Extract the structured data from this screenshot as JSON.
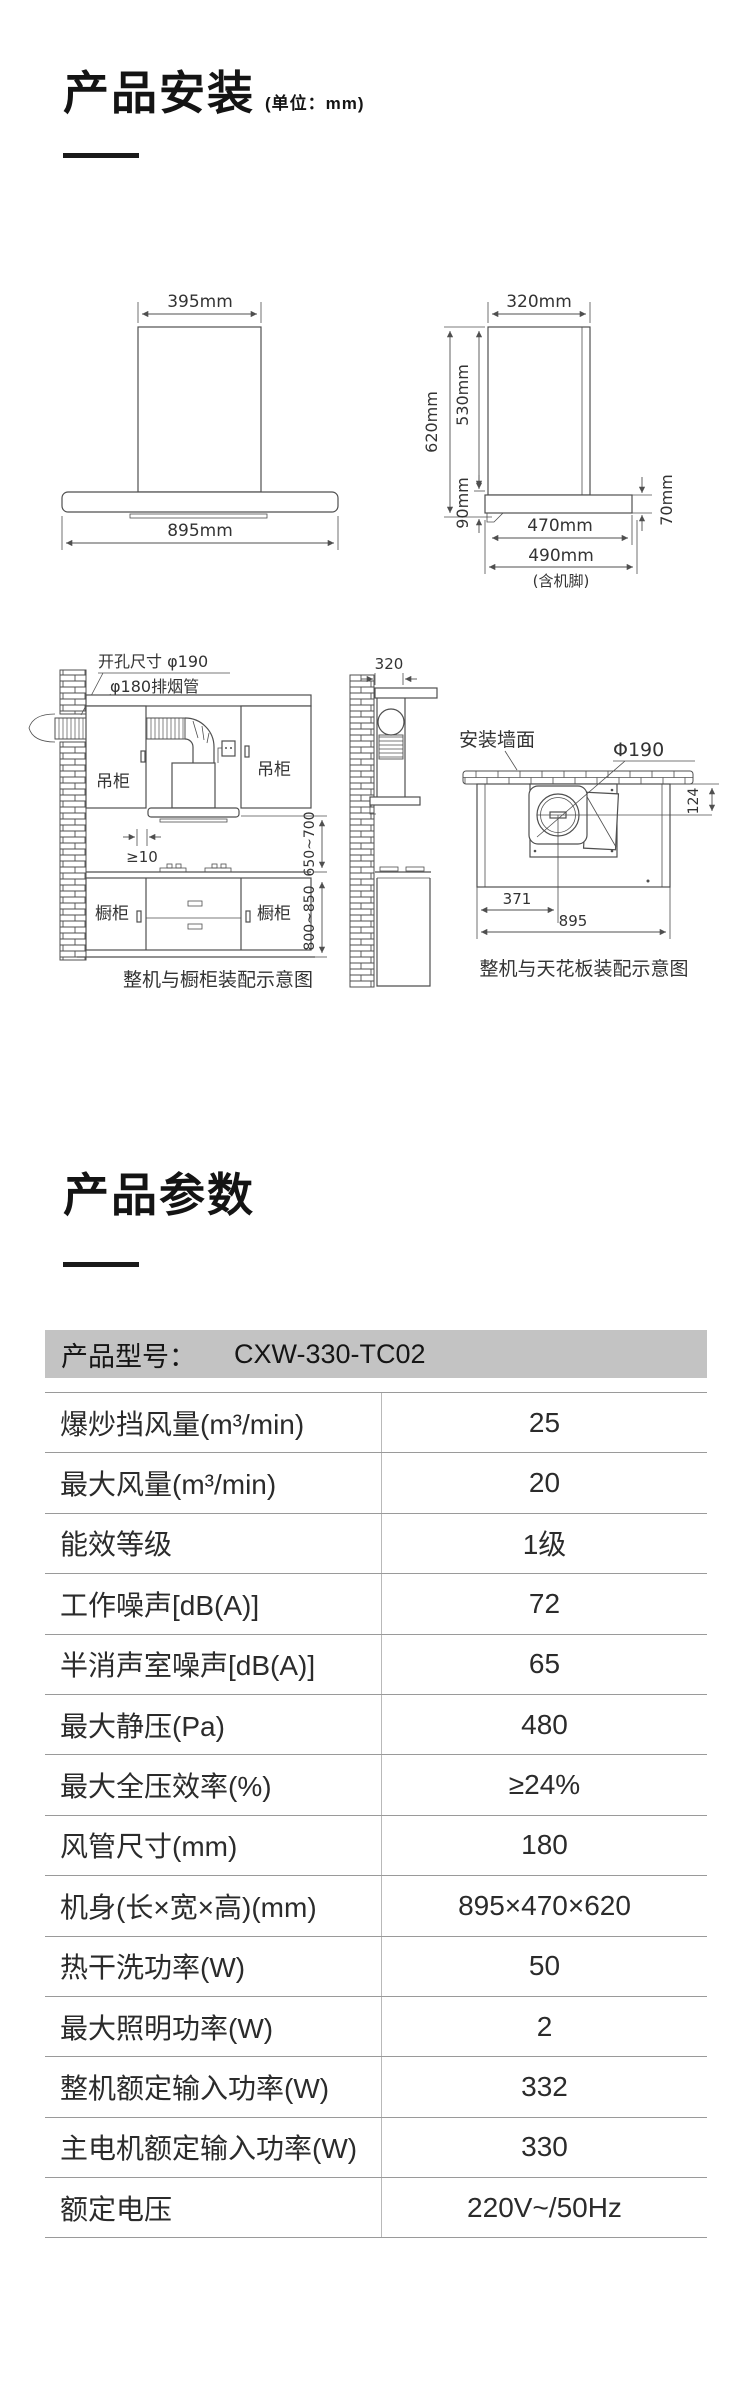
{
  "colors": {
    "header_bar": "#c3c3c3",
    "row_line": "#9a9a9a",
    "column_divider": "#b9b9b9",
    "ink": "#1a1a1a",
    "drawing_line": "#4f4f4f"
  },
  "install": {
    "title": "产品安装",
    "unit": "(单位：mm)",
    "front": {
      "w_top": "395mm",
      "w_body": "895mm"
    },
    "side": {
      "d_top": "320mm",
      "h_total": "620mm",
      "h_chimney": "530mm",
      "h_body": "90mm",
      "h_body_r": "70mm",
      "d_body": "470mm",
      "d_feet": "490mm",
      "feet_note": "(含机脚)"
    },
    "cabinet": {
      "hole": "开孔尺寸 φ190",
      "duct": "φ180排烟管",
      "hang": "吊柜",
      "base": "橱柜",
      "gap": "≥10",
      "h1": "650~700",
      "h2": "800~850",
      "caption": "整机与橱柜装配示意图"
    },
    "ceiling": {
      "d_top": "320",
      "wall": "安装墙面",
      "hole": "Φ190",
      "offset": "124",
      "center": "371",
      "width": "895",
      "caption": "整机与天花板装配示意图"
    }
  },
  "params": {
    "title": "产品参数",
    "model_label": "产品型号：",
    "model": "CXW-330-TC02",
    "rows": [
      {
        "label": "爆炒挡风量(m³/min)",
        "value": "25"
      },
      {
        "label": "最大风量(m³/min)",
        "value": "20"
      },
      {
        "label": "能效等级",
        "value": "1级"
      },
      {
        "label": "工作噪声[dB(A)]",
        "value": "72"
      },
      {
        "label": "半消声室噪声[dB(A)]",
        "value": "65"
      },
      {
        "label": "最大静压(Pa)",
        "value": "480"
      },
      {
        "label": "最大全压效率(%)",
        "value": "≥24%"
      },
      {
        "label": "风管尺寸(mm)",
        "value": "180"
      },
      {
        "label": "机身(长×宽×高)(mm)",
        "value": "895×470×620"
      },
      {
        "label": "热干洗功率(W)",
        "value": "50"
      },
      {
        "label": "最大照明功率(W)",
        "value": "2"
      },
      {
        "label": "整机额定输入功率(W)",
        "value": "332"
      },
      {
        "label": "主电机额定输入功率(W)",
        "value": "330"
      },
      {
        "label": "额定电压",
        "value": "220V~/50Hz"
      }
    ]
  }
}
